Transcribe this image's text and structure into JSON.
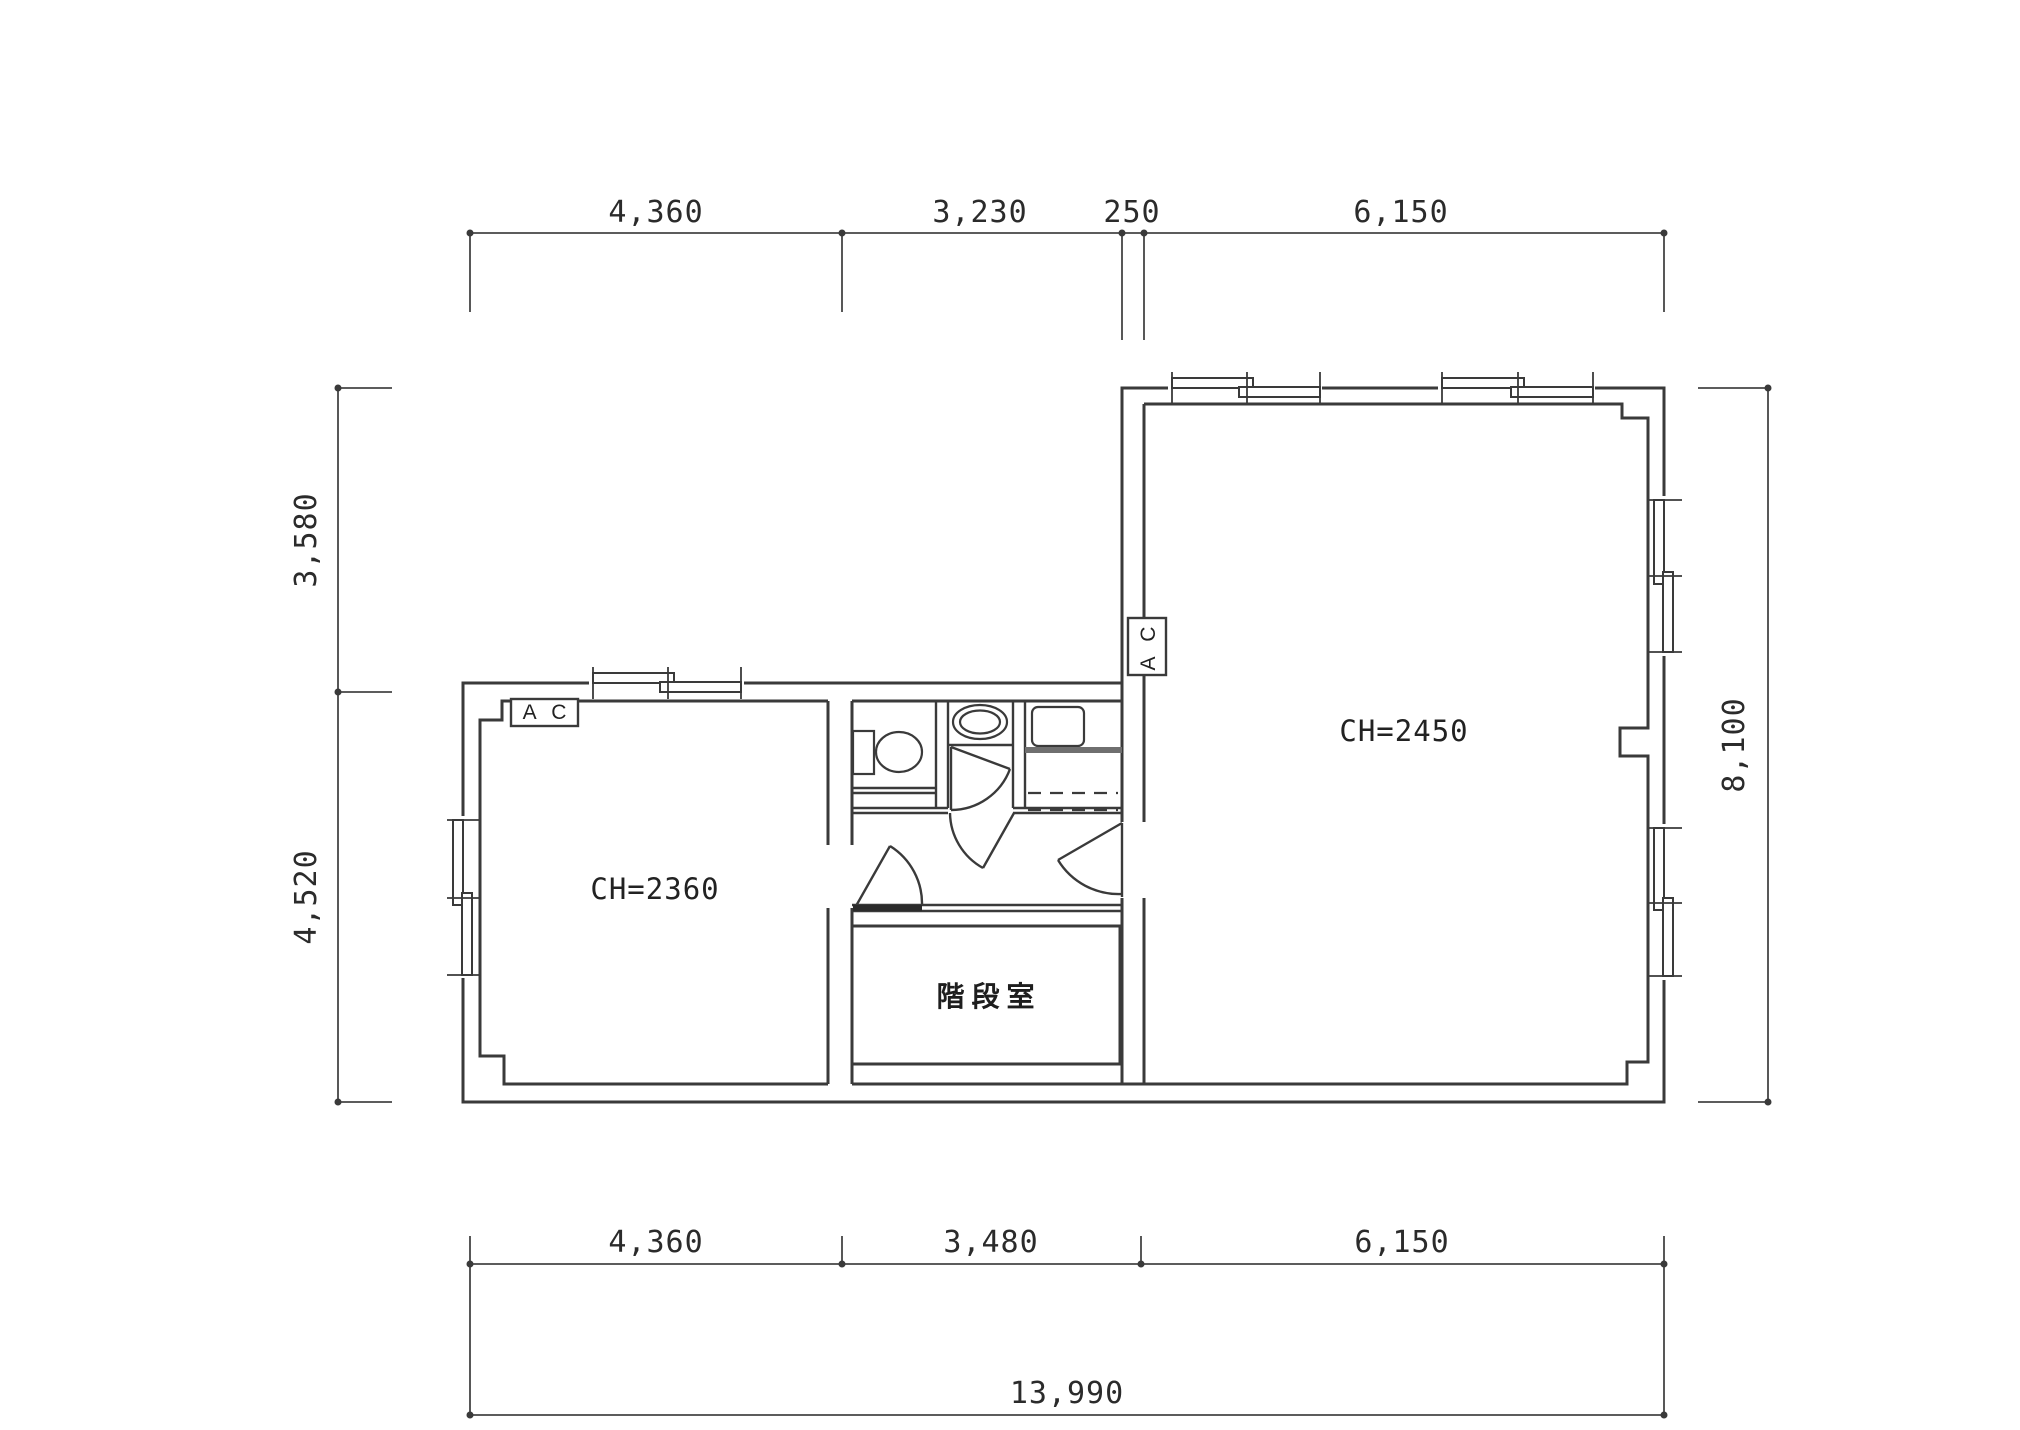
{
  "page": {
    "background": "#ffffff",
    "line_color": "#3a3a3a"
  },
  "dims": {
    "top": {
      "d1": "4,360",
      "d2": "3,230",
      "d3": "250",
      "d4": "6,150"
    },
    "left": {
      "d1": "3,580",
      "d2": "4,520"
    },
    "right": {
      "d1": "8,100"
    },
    "bottom": {
      "d1": "4,360",
      "d2": "3,480",
      "d3": "6,150",
      "total": "13,990"
    }
  },
  "rooms": {
    "left_room": {
      "ceiling_height": "CH=2360",
      "ac_label": "A C"
    },
    "right_room": {
      "ceiling_height": "CH=2450",
      "ac_label": "A C"
    },
    "stair_room": {
      "name": "階段室"
    }
  }
}
